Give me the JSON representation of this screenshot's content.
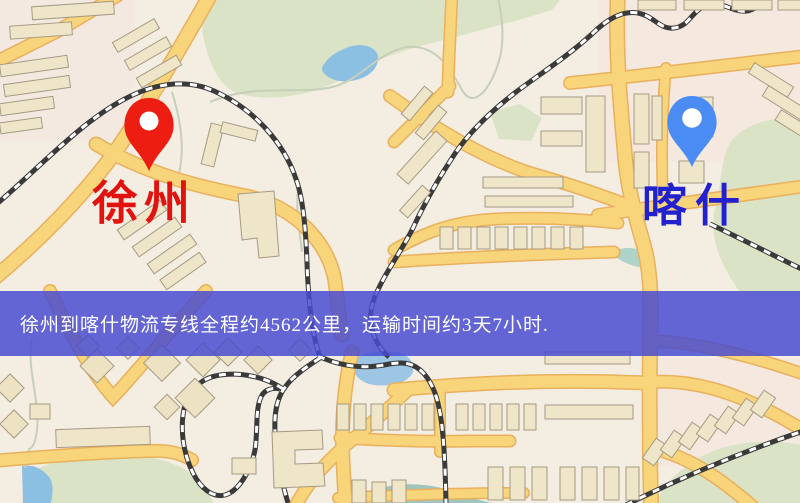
{
  "map": {
    "origin_marker": {
      "label": "徐州",
      "label_color": "#e2120e",
      "pin_color": "#ee1d12"
    },
    "destination_marker": {
      "label": "喀什",
      "label_color": "#2121cf",
      "pin_color": "#4a8cf4"
    },
    "banner": {
      "text": "徐州到喀什物流专线全程约4562公里，运输时间约3天7小时.",
      "background_color": "#484bd0",
      "text_color": "#ffffff"
    },
    "palette": {
      "land": "#f3ede2",
      "road_fill": "#f8d47b",
      "road_casing": "#e9b05e",
      "park": "#dbe3c6",
      "water": "#8cc0e2",
      "building_fill": "#efe5c9",
      "building_stroke": "#a69b82",
      "railway_dark": "#3a3a3a"
    }
  }
}
